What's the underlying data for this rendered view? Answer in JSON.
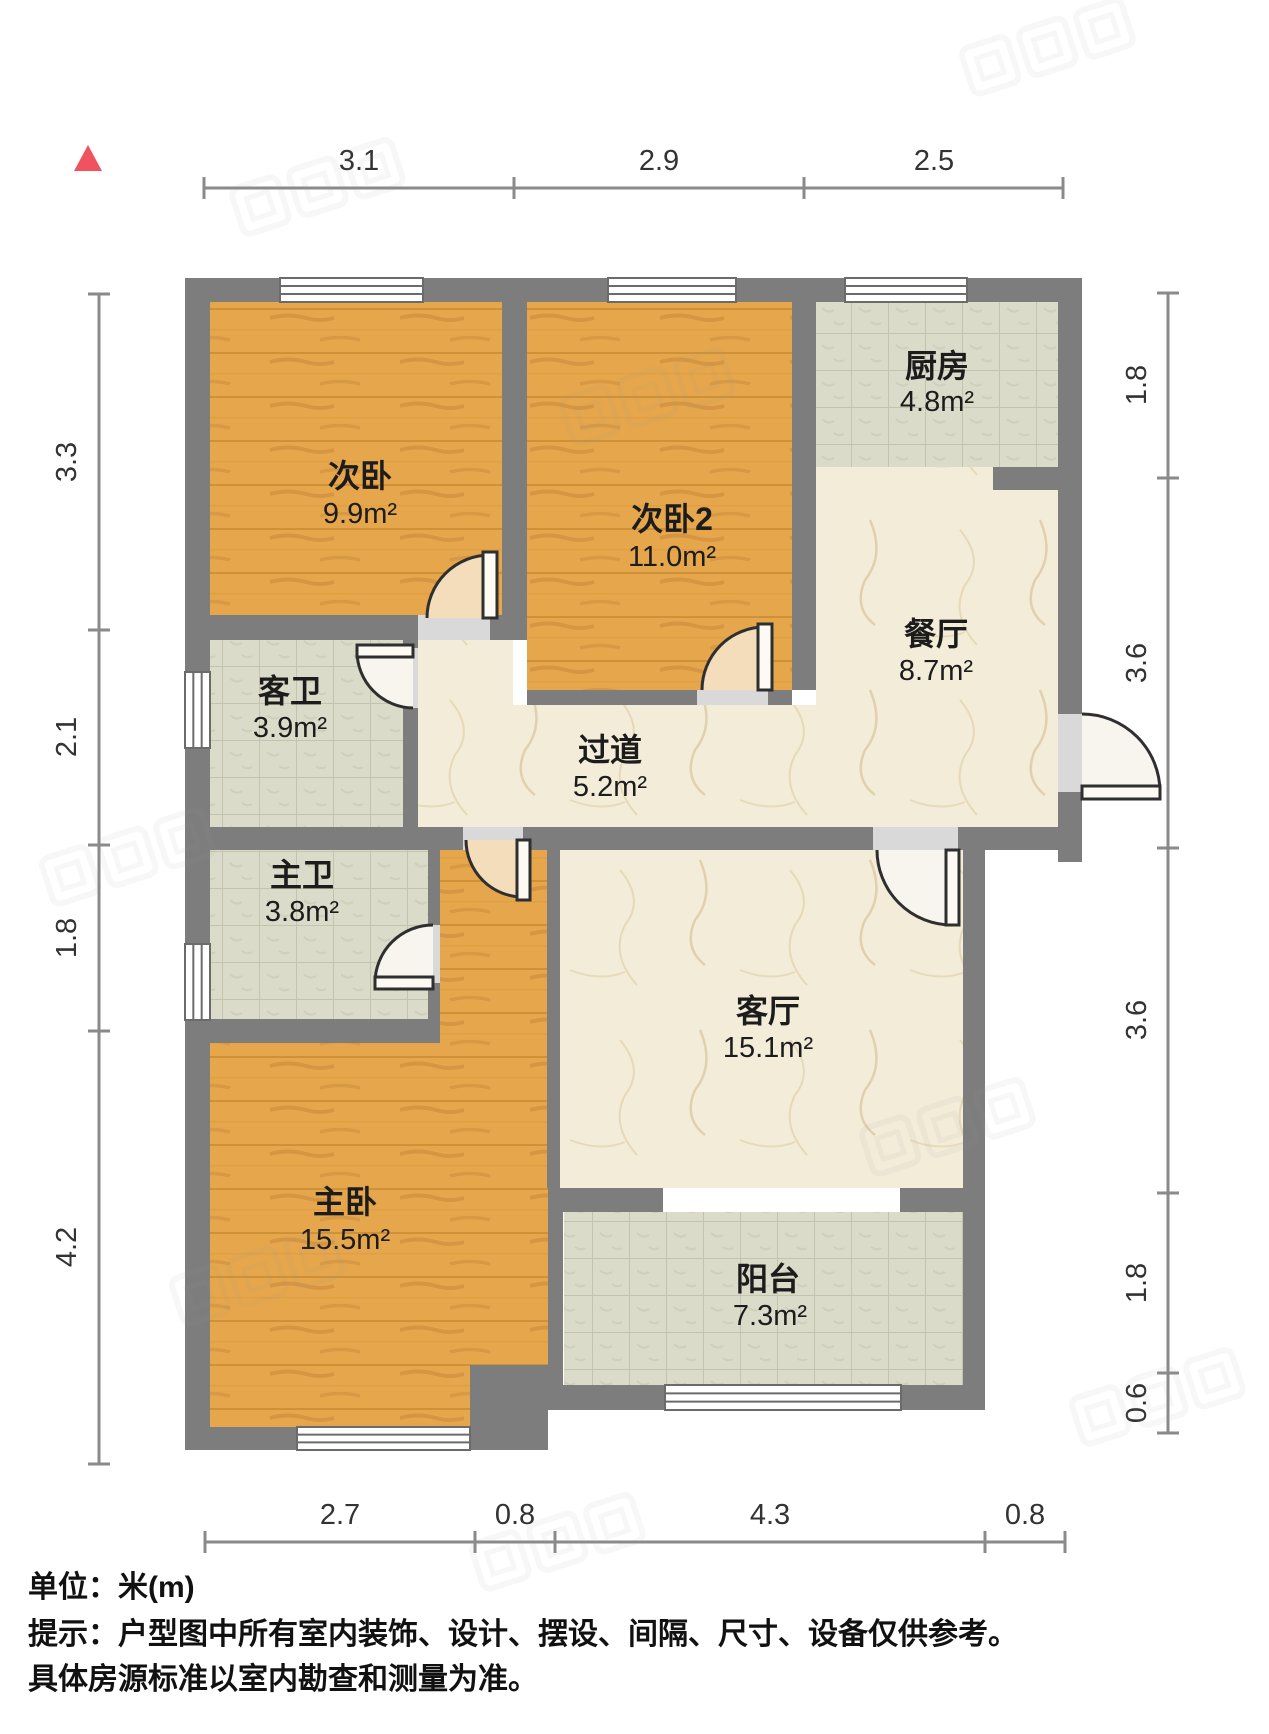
{
  "palette": {
    "wall": "#7d7d7d",
    "wood_base": "#e6a74c",
    "wood_grain": "#c8873a",
    "tile_base": "#dbdbc9",
    "tile_grid": "#c3c3af",
    "marble_base": "#f3ecd9",
    "marble_vein": "#dcc9a2",
    "door_wood_fill": "#f3ddba",
    "door_light_fill": "#f7f5ee",
    "panel_fill": "#fcfaf3",
    "opening_fill": "#d9d9d9",
    "outline": "#2f2f2f",
    "window_frame": "#6b6b6b",
    "dim_line": "#8a8a8a",
    "dim_text": "#333333",
    "north": "#f0525f",
    "label": "#1c1c1c",
    "watermark": "#999999"
  },
  "north_marker": {
    "points": "88,145 74,171 102,171"
  },
  "plan": {
    "floors": [
      {
        "id": "second-bedroom-floor",
        "type": "wood",
        "shape": "rect",
        "rect": [
          210,
          302,
          292,
          313
        ]
      },
      {
        "id": "second-bedroom-2-floor",
        "type": "wood",
        "shape": "rect",
        "rect": [
          527,
          302,
          265,
          388
        ]
      },
      {
        "id": "kitchen-floor",
        "type": "tile",
        "shape": "rect",
        "rect": [
          816,
          302,
          242,
          165
        ]
      },
      {
        "id": "dining-floor",
        "type": "marble",
        "shape": "rect",
        "rect": [
          816,
          467,
          242,
          360
        ]
      },
      {
        "id": "hallway-floor",
        "type": "marble",
        "shape": "polygon",
        "points": "418,640 513,640 513,705 816,705 816,827 418,827"
      },
      {
        "id": "guest-bath-floor",
        "type": "tile",
        "shape": "rect",
        "rect": [
          210,
          640,
          193,
          187
        ]
      },
      {
        "id": "master-bath-floor",
        "type": "tile",
        "shape": "rect",
        "rect": [
          210,
          850,
          218,
          169
        ]
      },
      {
        "id": "living-floor",
        "type": "marble",
        "shape": "rect",
        "rect": [
          560,
          850,
          403,
          338
        ]
      },
      {
        "id": "master-bedroom-floor",
        "type": "wood",
        "shape": "polygon",
        "points": "438,837 548,837 548,1365 470,1365 470,1427 210,1427 210,1043 438,1043"
      },
      {
        "id": "balcony-floor",
        "type": "tile",
        "shape": "rect",
        "rect": [
          564,
          1212,
          399,
          173
        ]
      }
    ],
    "walls": [
      [
        185,
        278,
        897,
        24
      ],
      [
        185,
        278,
        25,
        1172
      ],
      [
        1058,
        278,
        24,
        584
      ],
      [
        185,
        827,
        278,
        23
      ],
      [
        523,
        827,
        350,
        23
      ],
      [
        958,
        827,
        124,
        23
      ],
      [
        963,
        850,
        22,
        560
      ],
      [
        548,
        1385,
        437,
        25
      ],
      [
        185,
        1427,
        320,
        23
      ],
      [
        470,
        1365,
        78,
        85
      ],
      [
        502,
        302,
        25,
        338
      ],
      [
        792,
        302,
        24,
        388
      ],
      [
        993,
        467,
        65,
        23
      ],
      [
        185,
        615,
        233,
        25
      ],
      [
        490,
        615,
        37,
        25
      ],
      [
        527,
        690,
        170,
        15
      ],
      [
        768,
        690,
        24,
        15
      ],
      [
        403,
        705,
        15,
        122
      ],
      [
        403,
        640,
        15,
        8
      ],
      [
        428,
        850,
        12,
        75
      ],
      [
        428,
        983,
        12,
        36
      ],
      [
        210,
        1019,
        230,
        24
      ],
      [
        547,
        850,
        13,
        338
      ],
      [
        548,
        1188,
        15,
        222
      ],
      [
        548,
        1188,
        115,
        24
      ],
      [
        900,
        1188,
        63,
        24
      ]
    ],
    "windows": [
      {
        "id": "second-bedroom-window",
        "rect": [
          280,
          278,
          143,
          24
        ],
        "orient": "h"
      },
      {
        "id": "second-bedroom-2-window",
        "rect": [
          608,
          278,
          128,
          24
        ],
        "orient": "h"
      },
      {
        "id": "kitchen-window",
        "rect": [
          845,
          278,
          122,
          24
        ],
        "orient": "h"
      },
      {
        "id": "guest-bath-window",
        "rect": [
          185,
          672,
          25,
          76
        ],
        "orient": "v"
      },
      {
        "id": "master-bath-window",
        "rect": [
          185,
          944,
          25,
          76
        ],
        "orient": "v"
      },
      {
        "id": "master-bedroom-window",
        "rect": [
          297,
          1427,
          173,
          23
        ],
        "orient": "h"
      },
      {
        "id": "balcony-window",
        "rect": [
          665,
          1385,
          236,
          25
        ],
        "orient": "h"
      }
    ],
    "doors": [
      {
        "id": "second-bedroom-door",
        "opening": [
          418,
          615,
          72,
          25
        ],
        "sector": "M490,618 L427,618 A63,63 0 0 1 490,555 Z",
        "arc": "M427,618 A63,63 0 0 1 490,555",
        "panel": [
          483,
          552,
          14,
          66
        ],
        "fill": "wood"
      },
      {
        "id": "second-bedroom-2-door",
        "opening": [
          697,
          690,
          71,
          15
        ],
        "sector": "M765,690 L702,690 A63,63 0 0 1 765,627 Z",
        "arc": "M702,690 A63,63 0 0 1 765,627",
        "panel": [
          758,
          624,
          14,
          66
        ],
        "fill": "wood"
      },
      {
        "id": "guest-bath-door",
        "opening": [
          403,
          648,
          15,
          60
        ],
        "sector": "M413,651 L357,651 A57,57 0 0 0 413,708 Z",
        "arc": "M357,651 A57,57 0 0 0 413,708",
        "panel": [
          357,
          645,
          56,
          12
        ],
        "fill": "light"
      },
      {
        "id": "master-bath-door",
        "opening": [
          428,
          925,
          12,
          58
        ],
        "sector": "M433,983 L433,925 A58,58 0 0 0 375,983 Z",
        "arc": "M433,925 A58,58 0 0 0 375,983",
        "panel": [
          375,
          977,
          58,
          12
        ],
        "fill": "light"
      },
      {
        "id": "master-bedroom-door",
        "opening": [
          463,
          827,
          60,
          23
        ],
        "sector": "M523,840 L466,840 A57,57 0 0 0 523,897 Z",
        "arc": "M466,840 A57,57 0 0 0 523,897",
        "panel": [
          517,
          840,
          13,
          60
        ],
        "fill": "wood"
      },
      {
        "id": "living-room-door",
        "opening": [
          873,
          827,
          85,
          23
        ],
        "sector": "M952,850 L877,850 A75,75 0 0 0 952,925 Z",
        "arc": "M877,850 A75,75 0 0 0 952,925",
        "panel": [
          946,
          850,
          13,
          75
        ],
        "fill": "light"
      },
      {
        "id": "entry-door",
        "opening": [
          1058,
          714,
          24,
          78
        ],
        "sector": "M1082,792 L1082,714 A78,78 0 0 1 1160,792 Z",
        "arc": "M1082,714 A78,78 0 0 1 1160,792",
        "panel": [
          1082,
          786,
          78,
          13
        ],
        "fill": "light"
      }
    ],
    "rooms": [
      {
        "id": "second-bedroom",
        "name": "次卧",
        "area": "9.9m²",
        "nx": 360,
        "ny": 487,
        "ax": 360,
        "ay": 523
      },
      {
        "id": "second-bedroom-2",
        "name": "次卧2",
        "area": "11.0m²",
        "nx": 672,
        "ny": 530,
        "ax": 672,
        "ay": 566
      },
      {
        "id": "kitchen",
        "name": "厨房",
        "area": "4.8m²",
        "nx": 937,
        "ny": 377,
        "ax": 937,
        "ay": 411
      },
      {
        "id": "dining-room",
        "name": "餐厅",
        "area": "8.7m²",
        "nx": 936,
        "ny": 645,
        "ax": 936,
        "ay": 680
      },
      {
        "id": "guest-bathroom",
        "name": "客卫",
        "area": "3.9m²",
        "nx": 290,
        "ny": 702,
        "ax": 290,
        "ay": 737
      },
      {
        "id": "hallway",
        "name": "过道",
        "area": "5.2m²",
        "nx": 610,
        "ny": 761,
        "ax": 610,
        "ay": 796
      },
      {
        "id": "master-bathroom",
        "name": "主卫",
        "area": "3.8m²",
        "nx": 302,
        "ny": 886,
        "ax": 302,
        "ay": 921
      },
      {
        "id": "living-room",
        "name": "客厅",
        "area": "15.1m²",
        "nx": 768,
        "ny": 1022,
        "ax": 768,
        "ay": 1057
      },
      {
        "id": "master-bedroom",
        "name": "主卧",
        "area": "15.5m²",
        "nx": 345,
        "ny": 1213,
        "ax": 345,
        "ay": 1249
      },
      {
        "id": "balcony",
        "name": "阳台",
        "area": "7.3m²",
        "nx": 768,
        "ny": 1290,
        "ax": 770,
        "ay": 1325
      }
    ]
  },
  "dimensions": {
    "unit_px_per_m": 103,
    "chains": [
      {
        "id": "dim-top",
        "side": "top",
        "pos": 188,
        "from": 204,
        "to": 1063,
        "label_pos": 170,
        "ticks": [
          204,
          514,
          804,
          1063
        ],
        "labels": [
          {
            "text": "3.1",
            "at": 359
          },
          {
            "text": "2.9",
            "at": 659
          },
          {
            "text": "2.5",
            "at": 934
          }
        ]
      },
      {
        "id": "dim-bottom",
        "side": "bottom",
        "pos": 1542,
        "from": 205,
        "to": 1065,
        "label_pos": 1524,
        "ticks": [
          205,
          475,
          555,
          985,
          1065
        ],
        "labels": [
          {
            "text": "2.7",
            "at": 340
          },
          {
            "text": "0.8",
            "at": 515
          },
          {
            "text": "4.3",
            "at": 770
          },
          {
            "text": "0.8",
            "at": 1025
          }
        ]
      },
      {
        "id": "dim-left",
        "side": "left",
        "pos": 99,
        "from": 294,
        "to": 1464,
        "label_pos": 76,
        "ticks": [
          294,
          630,
          845,
          1031,
          1464
        ],
        "labels": [
          {
            "text": "3.3",
            "at": 462
          },
          {
            "text": "2.1",
            "at": 737
          },
          {
            "text": "1.8",
            "at": 938
          },
          {
            "text": "4.2",
            "at": 1247
          }
        ]
      },
      {
        "id": "dim-right",
        "side": "right",
        "pos": 1168,
        "from": 293,
        "to": 1433,
        "label_pos": 1146,
        "ticks": [
          293,
          478,
          848,
          1193,
          1373,
          1433
        ],
        "labels": [
          {
            "text": "1.8",
            "at": 385
          },
          {
            "text": "3.6",
            "at": 663
          },
          {
            "text": "3.6",
            "at": 1020
          },
          {
            "text": "1.8",
            "at": 1283
          },
          {
            "text": "0.6",
            "at": 1403
          }
        ]
      }
    ]
  },
  "watermarks": [
    {
      "x": 230,
      "y": 190,
      "r": -18
    },
    {
      "x": 960,
      "y": 50,
      "r": -18
    },
    {
      "x": 560,
      "y": 400,
      "r": -18
    },
    {
      "x": 40,
      "y": 860,
      "r": -18
    },
    {
      "x": 860,
      "y": 1130,
      "r": -18
    },
    {
      "x": 1070,
      "y": 1400,
      "r": -18
    },
    {
      "x": 470,
      "y": 1545,
      "r": -18
    },
    {
      "x": 170,
      "y": 1280,
      "r": -18
    }
  ],
  "footer": {
    "line1": "单位：米(m)",
    "line2": "提示：户型图中所有室内装饰、设计、摆设、间隔、尺寸、设备仅供参考。",
    "line3": "具体房源标准以室内勘查和测量为准。"
  }
}
